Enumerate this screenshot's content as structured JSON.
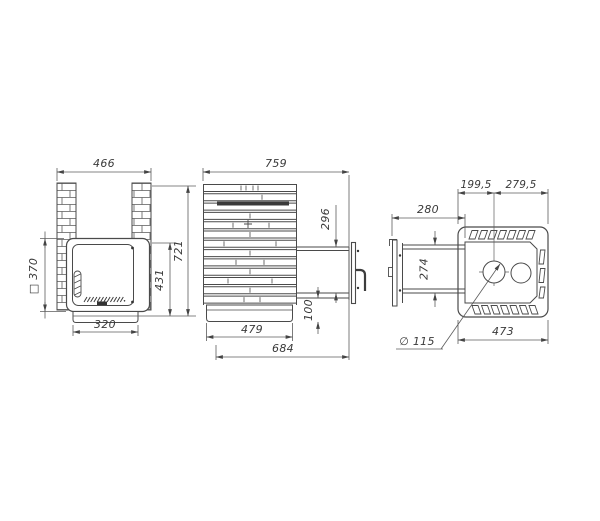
{
  "drawing": {
    "background": "#ffffff",
    "line_color": "#4a4a4a",
    "dim_color": "#555555",
    "front_view": {
      "overall_width": "466",
      "door_size": "□ 370",
      "overall_height": "721",
      "door_to_base_height": "431",
      "base_width": "320"
    },
    "side_view": {
      "overall_depth": "759",
      "portal_height": "296",
      "portal_base_offset": "100",
      "base_depth": "479",
      "depth_with_door": "684"
    },
    "top_view": {
      "flue_left_offset": "199,5",
      "flue_right_offset": "279,5",
      "tunnel_length": "280",
      "tunnel_width": "274",
      "flue_diameter": "∅ 115",
      "body_width": "473"
    }
  }
}
